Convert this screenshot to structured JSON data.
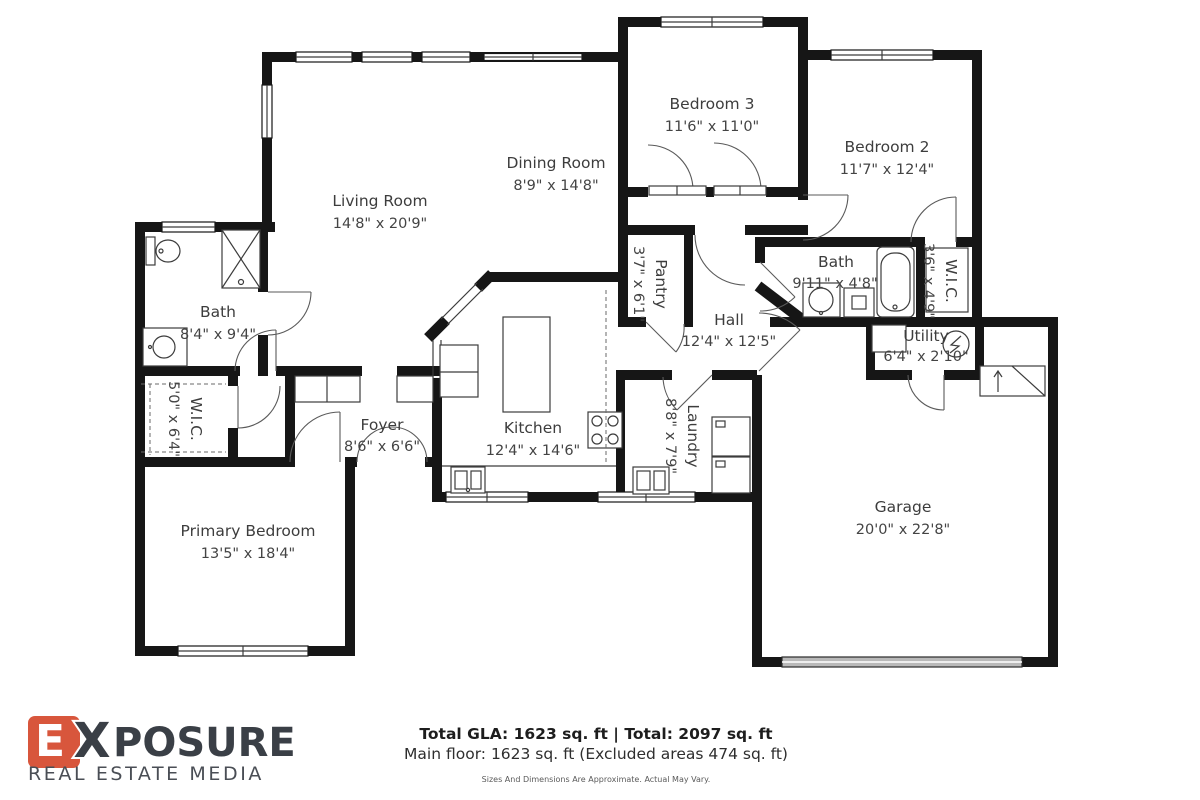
{
  "plan": {
    "rooms": [
      {
        "id": "living-room",
        "label": "Living Room",
        "dims": "14'8\" x 20'9\""
      },
      {
        "id": "dining-room",
        "label": "Dining Room",
        "dims": "8'9\" x 14'8\""
      },
      {
        "id": "bedroom-3",
        "label": "Bedroom 3",
        "dims": "11'6\" x 11'0\""
      },
      {
        "id": "bedroom-2",
        "label": "Bedroom 2",
        "dims": "11'7\" x 12'4\""
      },
      {
        "id": "bath-left",
        "label": "Bath",
        "dims": "8'4\" x 9'4\""
      },
      {
        "id": "wic-left",
        "label": "W.I.C.",
        "dims": "5'0\" x 6'4\""
      },
      {
        "id": "foyer",
        "label": "Foyer",
        "dims": "8'6\" x 6'6\""
      },
      {
        "id": "kitchen",
        "label": "Kitchen",
        "dims": "12'4\" x 14'6\""
      },
      {
        "id": "pantry",
        "label": "Pantry",
        "dims": "3'7\" x 6'1\""
      },
      {
        "id": "hall",
        "label": "Hall",
        "dims": "12'4\" x 12'5\""
      },
      {
        "id": "bath-right",
        "label": "Bath",
        "dims": "9'11\" x 4'8\""
      },
      {
        "id": "wic-right",
        "label": "W.I.C.",
        "dims": "3'6\" x 4'9\""
      },
      {
        "id": "utility",
        "label": "Utility",
        "dims": "6'4\" x 2'10\""
      },
      {
        "id": "laundry",
        "label": "Laundry",
        "dims": "8'8\" x 7'9\""
      },
      {
        "id": "primary-bedroom",
        "label": "Primary Bedroom",
        "dims": "13'5\" x 18'4\""
      },
      {
        "id": "garage",
        "label": "Garage",
        "dims": "20'0\" x 22'8\""
      }
    ]
  },
  "logo": {
    "letter_accent": "E",
    "letter_x": "X",
    "name_rest": "POSURE",
    "subtitle": "REAL ESTATE MEDIA",
    "accent_color": "#d8563c",
    "text_color": "#3a3f46"
  },
  "footer": {
    "totals": "Total GLA: 1623 sq. ft | Total: 2097 sq. ft",
    "main_floor": "Main floor: 1623 sq. ft (Excluded areas 474 sq. ft)",
    "disclaimer": "Sizes And Dimensions Are Approximate. Actual May Vary."
  }
}
